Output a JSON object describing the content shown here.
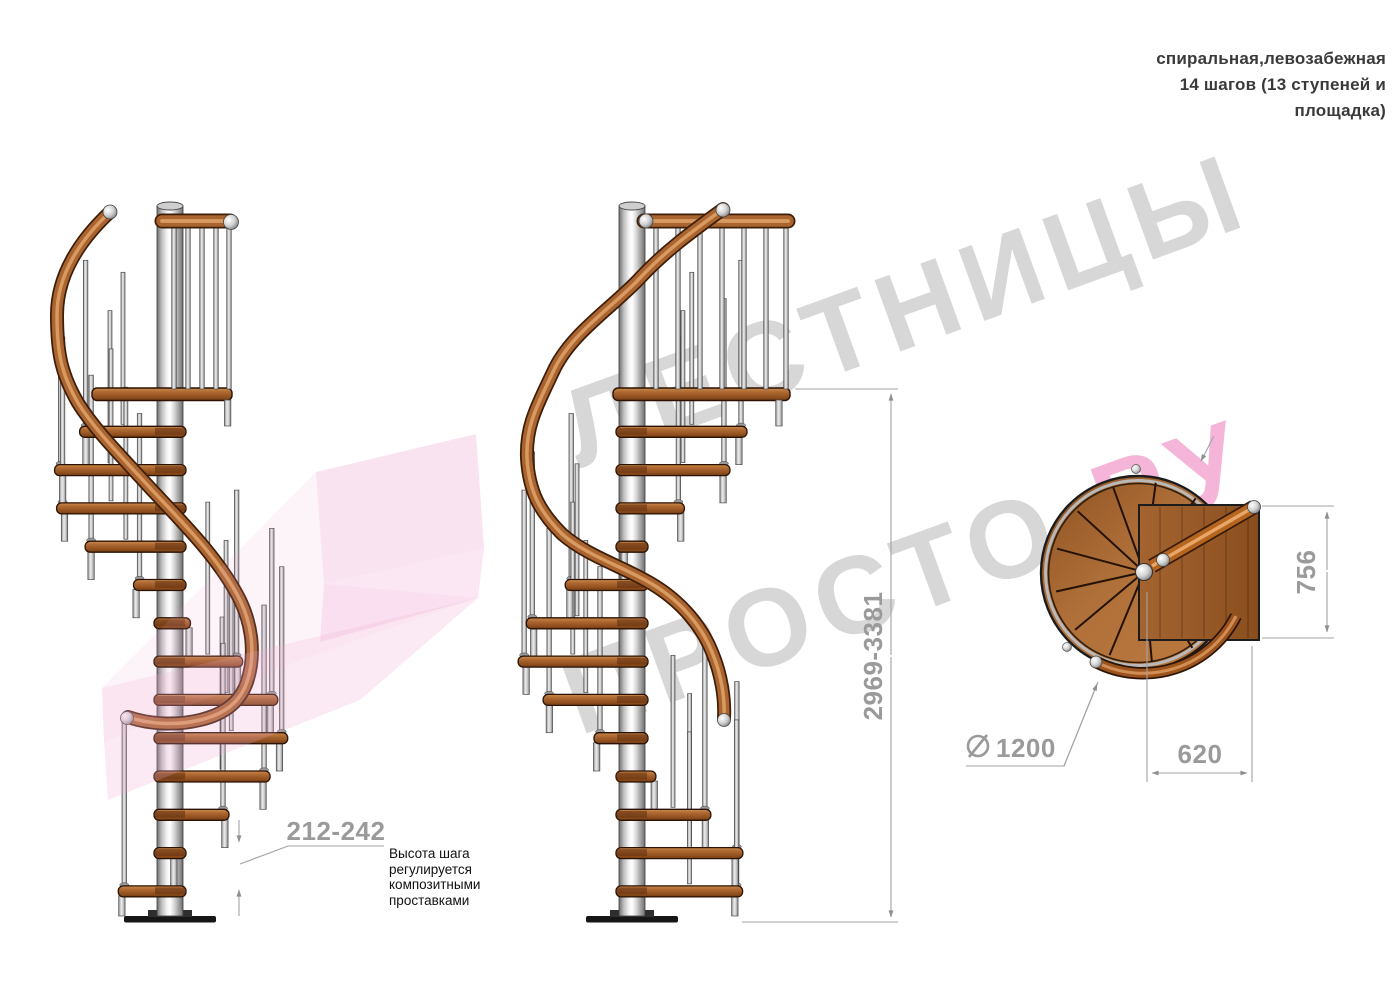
{
  "header": {
    "lines": [
      "спиральная,левозабежная",
      "14 шагов (13 ступеней и",
      "площадка)"
    ]
  },
  "stair": {
    "type": "спиральная",
    "turn": "левозабежная",
    "steps_total": 14,
    "treads": 13,
    "has_platform": true
  },
  "dimensions": {
    "step_rise_range_mm": "212-242",
    "total_height_range_mm": "2969-3381",
    "platform_depth_mm": "756",
    "platform_width_mm": "620",
    "diameter_mm": "1200"
  },
  "note": {
    "lines": [
      "Высота шага",
      "регулируется",
      "композитными",
      "проставками"
    ]
  },
  "watermark": {
    "line1": "ЛЕСТНИЦЫ",
    "line2": "ПРОСТО",
    "line2_accent": ".РУ"
  },
  "colors": {
    "wood": "#a9642f",
    "wood_dark": "#5d2d0e",
    "steel": "#d9d9d9",
    "dimension_gray": "#9a9a9a",
    "watermark_gray": "#d7d7d7",
    "watermark_pink": "#f5b5d8",
    "arrow_pink": "#efa8d2"
  }
}
